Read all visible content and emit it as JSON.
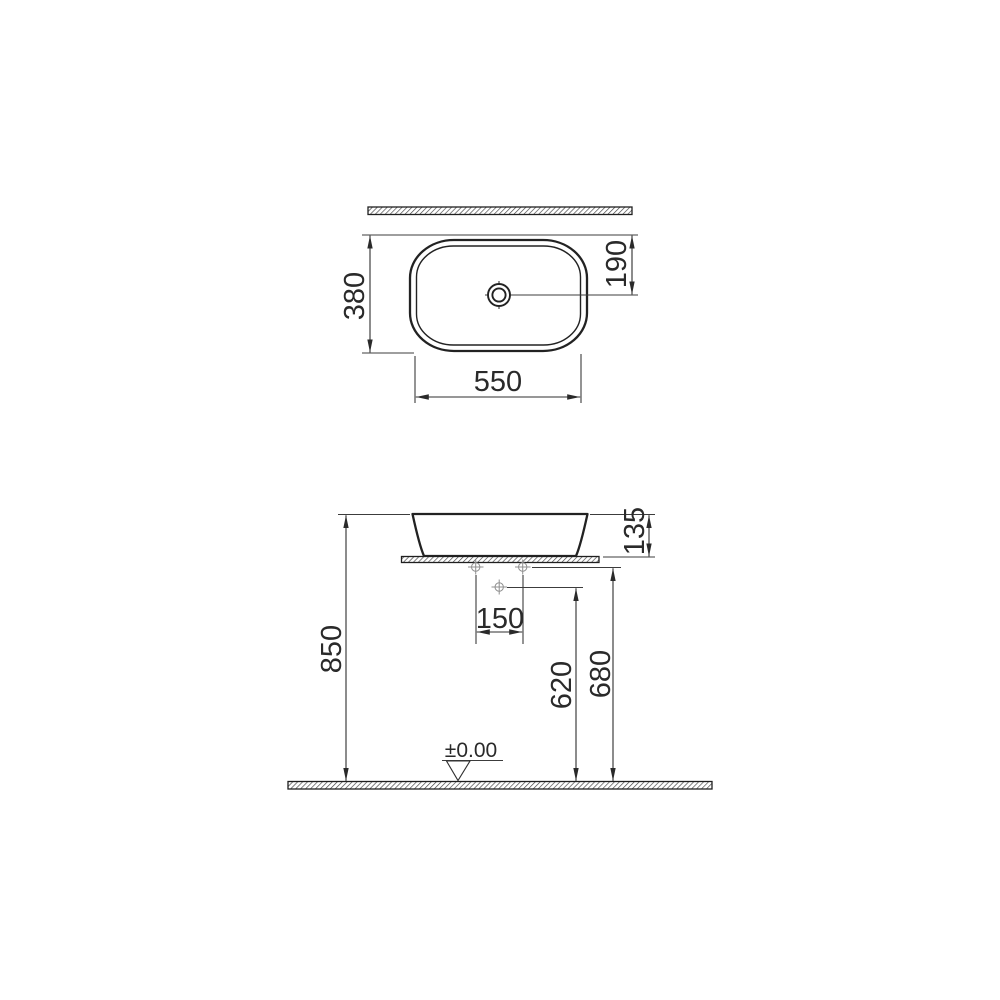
{
  "dims": {
    "depth": "380",
    "drain_center_offset": "190",
    "width": "550",
    "bowl_height": "135",
    "rim_height": "850",
    "drain_height": "620",
    "supply_height": "680",
    "supply_spacing": "150",
    "floor_level": "±0.00"
  },
  "colors": {
    "background": "#ffffff",
    "line": "#2a2a2a",
    "marker_gray": "#8f8f8f"
  }
}
